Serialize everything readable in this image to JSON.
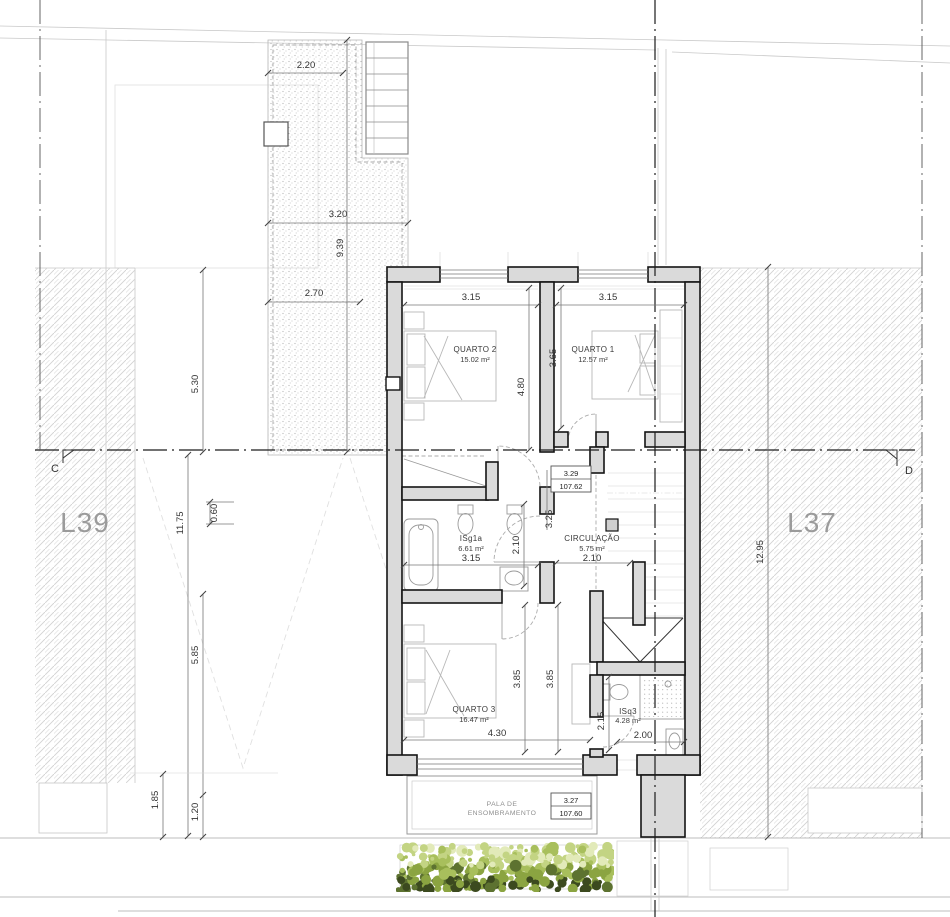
{
  "lots": {
    "left": "L39",
    "right": "L37"
  },
  "section_markers": {
    "left": "C",
    "right": "D"
  },
  "rooms": {
    "quarto2": {
      "name": "QUARTO 2",
      "area": "15.02 m²"
    },
    "quarto1": {
      "name": "QUARTO 1",
      "area": "12.57 m²"
    },
    "isg1a": {
      "name": "ISg1a",
      "area": "6.61 m²"
    },
    "circulacao": {
      "name": "CIRCULAÇÃO",
      "area": "5.75 m²"
    },
    "quarto3": {
      "name": "QUARTO 3",
      "area": "16.47 m²"
    },
    "isq3": {
      "name": "ISq3",
      "area": "4.28 m²"
    }
  },
  "levels": {
    "upper": {
      "height": "3.29",
      "elevation": "107.62"
    },
    "lower": {
      "height": "3.27",
      "elevation": "107.60"
    }
  },
  "shading_canopy": {
    "line1": "PALA DE",
    "line2": "ENSOMBRAMENTO"
  },
  "dims": {
    "terrace": [
      "2.20",
      "3.20",
      "9.39",
      "2.70"
    ],
    "site_left": [
      "5.30",
      "11.75",
      "0.60",
      "5.85",
      "1.85",
      "1.20"
    ],
    "site_right": [
      "12.95"
    ],
    "quarto2": [
      "3.15",
      "4.80"
    ],
    "quarto1": [
      "3.15",
      "3.65"
    ],
    "isg1a": [
      "3.15",
      "2.10"
    ],
    "circulacao": [
      "2.10",
      "3.25"
    ],
    "quarto3": [
      "4.30",
      "3.85",
      "3.85"
    ],
    "isq3": [
      "2.00",
      "2.15"
    ]
  },
  "veg_colors": [
    "#c3d483",
    "#a8bf5c",
    "#8ba441",
    "#5d7230",
    "#3c4a1f",
    "#e2eab9"
  ]
}
